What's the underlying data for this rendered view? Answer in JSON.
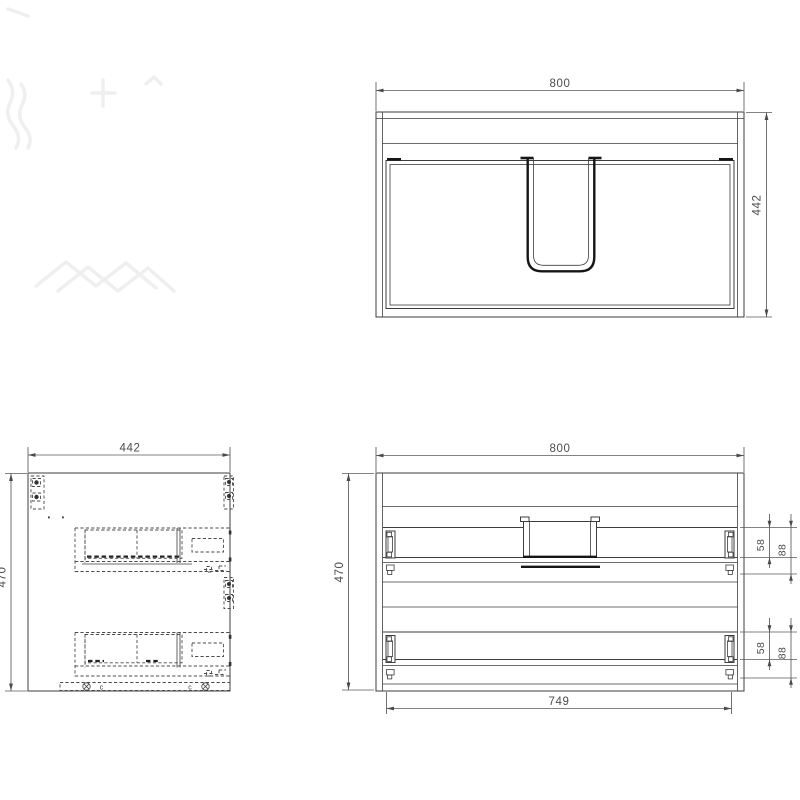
{
  "colors": {
    "background": "#ffffff",
    "line": "#3d3d3d",
    "heavy_line": "#161616",
    "dashed_hidden_line": "#4a4a4a",
    "dimension": "#4c4c4c",
    "watermark": "#efefef"
  },
  "views": {
    "top": {
      "dims": {
        "width": "800",
        "depth": "442"
      }
    },
    "side": {
      "dims": {
        "width": "442",
        "height": "470"
      },
      "annotations": {
        "bottom_marker_left": "c",
        "bottom_marker_right": "c"
      }
    },
    "back": {
      "dims": {
        "width": "800",
        "height": "470",
        "inner_width": "749",
        "upper_drawer_back": "58",
        "upper_drawer_total": "88",
        "lower_drawer_back": "58",
        "lower_drawer_total": "88"
      }
    }
  }
}
